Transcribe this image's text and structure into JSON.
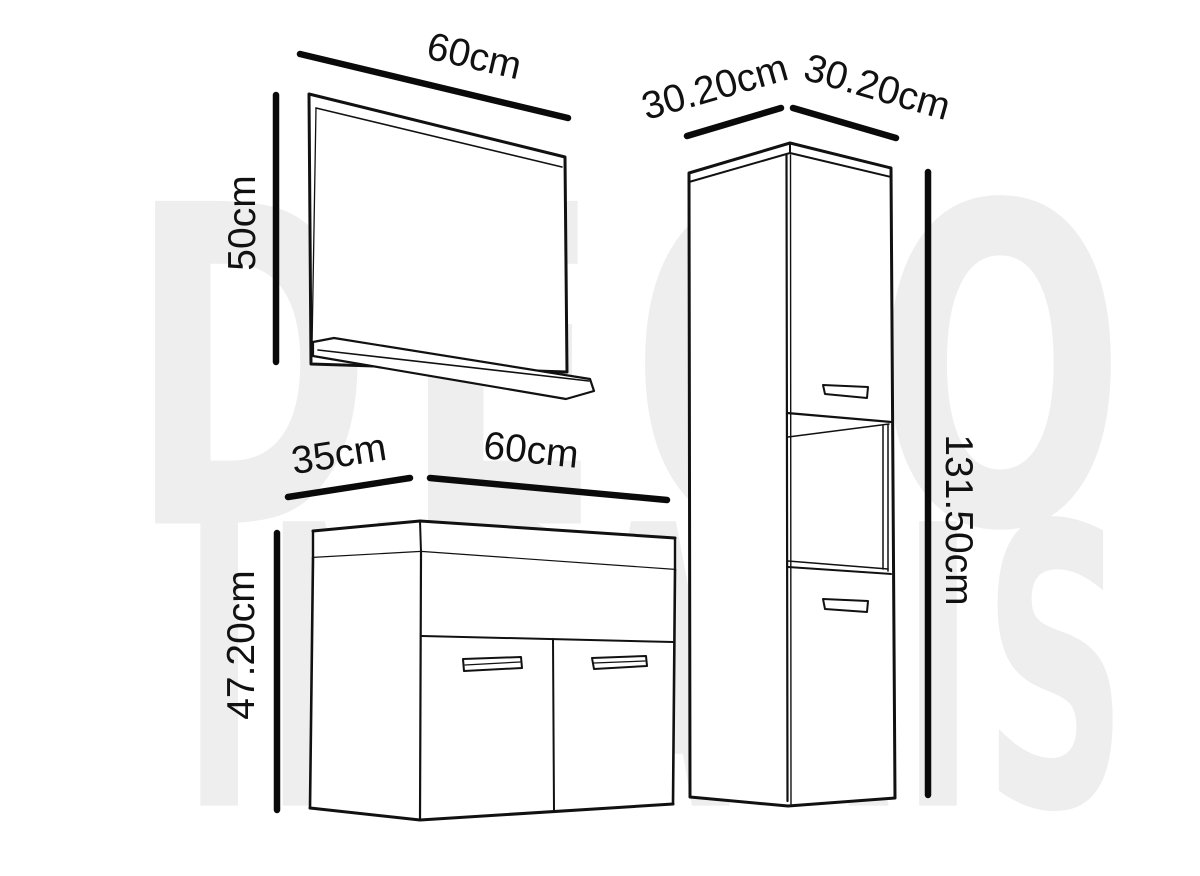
{
  "diagram": {
    "mirror": {
      "width": "60cm",
      "height": "50cm"
    },
    "vanity": {
      "depth": "35cm",
      "width": "60cm",
      "height": "47.20cm"
    },
    "column": {
      "depth": "30.20cm",
      "width": "30.20cm",
      "height": "131.50cm"
    }
  },
  "watermark": {
    "line1": "DECO",
    "line2": "INPARIS",
    "color": "#eeeeee"
  },
  "colors": {
    "background": "#ffffff",
    "line": "#111111",
    "dimension_line": "#0a0a0a"
  }
}
